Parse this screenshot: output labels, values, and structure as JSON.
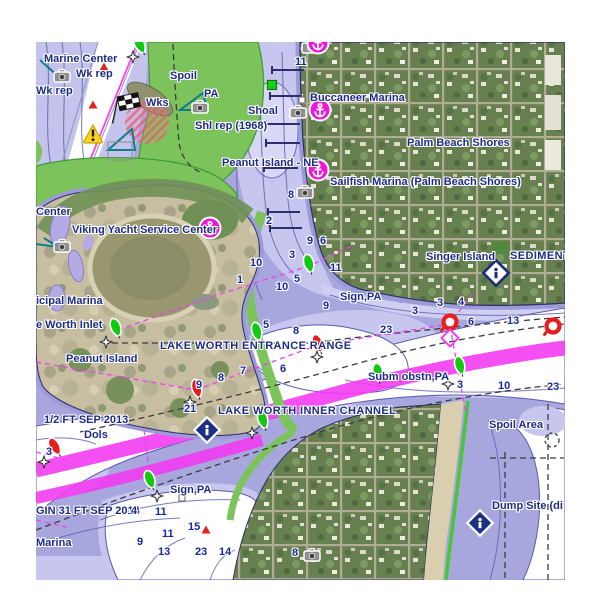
{
  "chart": {
    "colors": {
      "water_mid": "#a7a7de",
      "water_light": "#c6c6ee",
      "water_pale": "#d8d8f5",
      "water_deep": "#ffffff",
      "shallow_strip": "#9b9bd8",
      "contour": "#5a5ab0",
      "green_shallow": "#7cc35c",
      "green_edge": "#3f9a38",
      "beach_green": "#49c633",
      "magenta": "#f23cf2",
      "navy_label": "#1c2b86",
      "depth_label": "#18289b",
      "land_green": "#6d8a55",
      "sand": "#c7bda0",
      "buoy_green": "#12c912",
      "buoy_red": "#e81d1d",
      "marina_magenta": "#f016d8",
      "warning_yellow": "#ffd31c",
      "teal": "#0e7d8a"
    },
    "labels": [
      {
        "t": "Marine Center",
        "x": 44,
        "y": 60
      },
      {
        "t": "Wk rep",
        "x": 76,
        "y": 75
      },
      {
        "t": "Wk rep",
        "x": 36,
        "y": 92
      },
      {
        "t": "Spoil",
        "x": 170,
        "y": 77
      },
      {
        "t": "Wks",
        "x": 146,
        "y": 104
      },
      {
        "t": "PA",
        "x": 204,
        "y": 95
      },
      {
        "t": "Shl rep (1968)",
        "x": 195,
        "y": 127
      },
      {
        "t": "Shoal",
        "x": 248,
        "y": 112
      },
      {
        "t": "Buccaneer Marina",
        "x": 310,
        "y": 99
      },
      {
        "t": "Palm Beach Shores",
        "x": 407,
        "y": 144
      },
      {
        "t": "Peanut Island - NE",
        "x": 222,
        "y": 164
      },
      {
        "t": "Sailfish Marina (Palm Beach Shores)",
        "x": 330,
        "y": 183
      },
      {
        "t": "Singer Island",
        "x": 426,
        "y": 258
      },
      {
        "t": "SEDIMENT",
        "x": 510,
        "y": 257,
        "cls": "caps"
      },
      {
        "t": "Center",
        "x": 36,
        "y": 213
      },
      {
        "t": "Viking Yacht Service Center",
        "x": 72,
        "y": 231
      },
      {
        "t": "icipal Marina",
        "x": 36,
        "y": 302
      },
      {
        "t": "e Worth Inlet",
        "x": 36,
        "y": 326
      },
      {
        "t": "Peanut Island",
        "x": 66,
        "y": 360
      },
      {
        "t": "LAKE WORTH ENTRANCE RANGE",
        "x": 160,
        "y": 347,
        "cls": "caps"
      },
      {
        "t": "Sign,PA",
        "x": 340,
        "y": 298
      },
      {
        "t": "Subm obstn,PA",
        "x": 368,
        "y": 378
      },
      {
        "t": "1/2 FT SEP 2013",
        "x": 44,
        "y": 421
      },
      {
        "t": "Dols",
        "x": 84,
        "y": 436
      },
      {
        "t": "LAKE WORTH INNER CHANNEL",
        "x": 218,
        "y": 412,
        "cls": "caps"
      },
      {
        "t": "Sign,PA",
        "x": 170,
        "y": 491
      },
      {
        "t": "GIN 31 FT SEP 2014",
        "x": 36,
        "y": 512
      },
      {
        "t": "Marina",
        "x": 36,
        "y": 544
      },
      {
        "t": "Spoil Area",
        "x": 489,
        "y": 426
      },
      {
        "t": "Dump Site (di",
        "x": 492,
        "y": 507
      }
    ],
    "depths": [
      {
        "v": "11",
        "x": 295,
        "y": 63
      },
      {
        "v": "8",
        "x": 288,
        "y": 196
      },
      {
        "v": "2",
        "x": 266,
        "y": 222
      },
      {
        "v": "9",
        "x": 307,
        "y": 242
      },
      {
        "v": "6",
        "x": 320,
        "y": 242
      },
      {
        "v": "3",
        "x": 289,
        "y": 256
      },
      {
        "v": "10",
        "x": 250,
        "y": 264
      },
      {
        "v": "11",
        "x": 330,
        "y": 269
      },
      {
        "v": "1",
        "x": 237,
        "y": 281
      },
      {
        "v": "5",
        "x": 294,
        "y": 280
      },
      {
        "v": "10",
        "x": 276,
        "y": 288
      },
      {
        "v": "9",
        "x": 323,
        "y": 307
      },
      {
        "v": "5",
        "x": 263,
        "y": 326
      },
      {
        "v": "8",
        "x": 293,
        "y": 332
      },
      {
        "v": "23",
        "x": 380,
        "y": 331
      },
      {
        "v": "3",
        "x": 412,
        "y": 312
      },
      {
        "v": "3",
        "x": 437,
        "y": 304
      },
      {
        "v": "4",
        "x": 458,
        "y": 303
      },
      {
        "v": "6",
        "x": 468,
        "y": 323
      },
      {
        "v": "13",
        "x": 507,
        "y": 322
      },
      {
        "v": "7",
        "x": 240,
        "y": 372
      },
      {
        "v": "6",
        "x": 280,
        "y": 370
      },
      {
        "v": "8",
        "x": 218,
        "y": 379
      },
      {
        "v": "9",
        "x": 196,
        "y": 386
      },
      {
        "v": "21",
        "x": 184,
        "y": 410
      },
      {
        "v": "3",
        "x": 457,
        "y": 386
      },
      {
        "v": "10",
        "x": 498,
        "y": 387
      },
      {
        "v": "23",
        "x": 547,
        "y": 388
      },
      {
        "v": "3",
        "x": 46,
        "y": 453
      },
      {
        "v": "4",
        "x": 131,
        "y": 512
      },
      {
        "v": "11",
        "x": 155,
        "y": 513
      },
      {
        "v": "15",
        "x": 188,
        "y": 528
      },
      {
        "v": "11",
        "x": 162,
        "y": 535
      },
      {
        "v": "9",
        "x": 137,
        "y": 543
      },
      {
        "v": "13",
        "x": 158,
        "y": 553
      },
      {
        "v": "23",
        "x": 195,
        "y": 553
      },
      {
        "v": "14",
        "x": 219,
        "y": 553
      },
      {
        "v": "8",
        "x": 292,
        "y": 554
      }
    ],
    "buoys": [
      {
        "k": "green",
        "x": 140,
        "y": 45,
        "r": -25
      },
      {
        "k": "green",
        "x": 116,
        "y": 328,
        "r": -20
      },
      {
        "k": "green",
        "x": 257,
        "y": 332,
        "r": -15
      },
      {
        "k": "green",
        "x": 309,
        "y": 264,
        "r": -15
      },
      {
        "k": "green",
        "x": 378,
        "y": 373,
        "r": -10
      },
      {
        "k": "green",
        "x": 460,
        "y": 366,
        "r": -15
      },
      {
        "k": "green",
        "x": 263,
        "y": 420,
        "r": -15
      },
      {
        "k": "green",
        "x": 150,
        "y": 480,
        "r": -20
      },
      {
        "k": "red",
        "x": 197,
        "y": 389,
        "r": -15
      },
      {
        "k": "red",
        "x": 318,
        "y": 344,
        "r": -20
      },
      {
        "k": "red",
        "x": 55,
        "y": 447,
        "r": -30
      },
      {
        "k": "ring",
        "x": 450,
        "y": 322,
        "r": 0
      },
      {
        "k": "ring",
        "x": 553,
        "y": 326,
        "r": 0
      }
    ],
    "stars": [
      [
        133,
        57
      ],
      [
        106,
        342
      ],
      [
        317,
        357
      ],
      [
        190,
        402
      ],
      [
        44,
        462
      ],
      [
        157,
        496
      ],
      [
        252,
        433
      ],
      [
        448,
        384
      ]
    ],
    "symbols": [
      {
        "k": "camera",
        "x": 62,
        "y": 77
      },
      {
        "k": "camera",
        "x": 200,
        "y": 108
      },
      {
        "k": "camera",
        "x": 310,
        "y": 48
      },
      {
        "k": "camera",
        "x": 298,
        "y": 113
      },
      {
        "k": "camera",
        "x": 305,
        "y": 193
      },
      {
        "k": "camera",
        "x": 62,
        "y": 247
      },
      {
        "k": "camera",
        "x": 312,
        "y": 556
      },
      {
        "k": "marina",
        "x": 318,
        "y": 43
      },
      {
        "k": "marina",
        "x": 320,
        "y": 110
      },
      {
        "k": "marina",
        "x": 318,
        "y": 170
      },
      {
        "k": "marina",
        "x": 210,
        "y": 228
      },
      {
        "k": "warning",
        "x": 93,
        "y": 134
      },
      {
        "k": "flag",
        "x": 118,
        "y": 106
      },
      {
        "k": "greensq",
        "x": 272,
        "y": 85
      },
      {
        "k": "redtri",
        "x": 104,
        "y": 67
      },
      {
        "k": "redtri",
        "x": 93,
        "y": 105
      },
      {
        "k": "redtri",
        "x": 206,
        "y": 530
      },
      {
        "k": "infowhite",
        "x": 496,
        "y": 273
      },
      {
        "k": "infonavy",
        "x": 207,
        "y": 430
      },
      {
        "k": "infonavy",
        "x": 480,
        "y": 523
      },
      {
        "k": "magdiamond",
        "x": 450,
        "y": 338
      },
      {
        "k": "whitesq",
        "x": 302,
        "y": 100
      },
      {
        "k": "whitesq",
        "x": 182,
        "y": 498
      }
    ]
  }
}
